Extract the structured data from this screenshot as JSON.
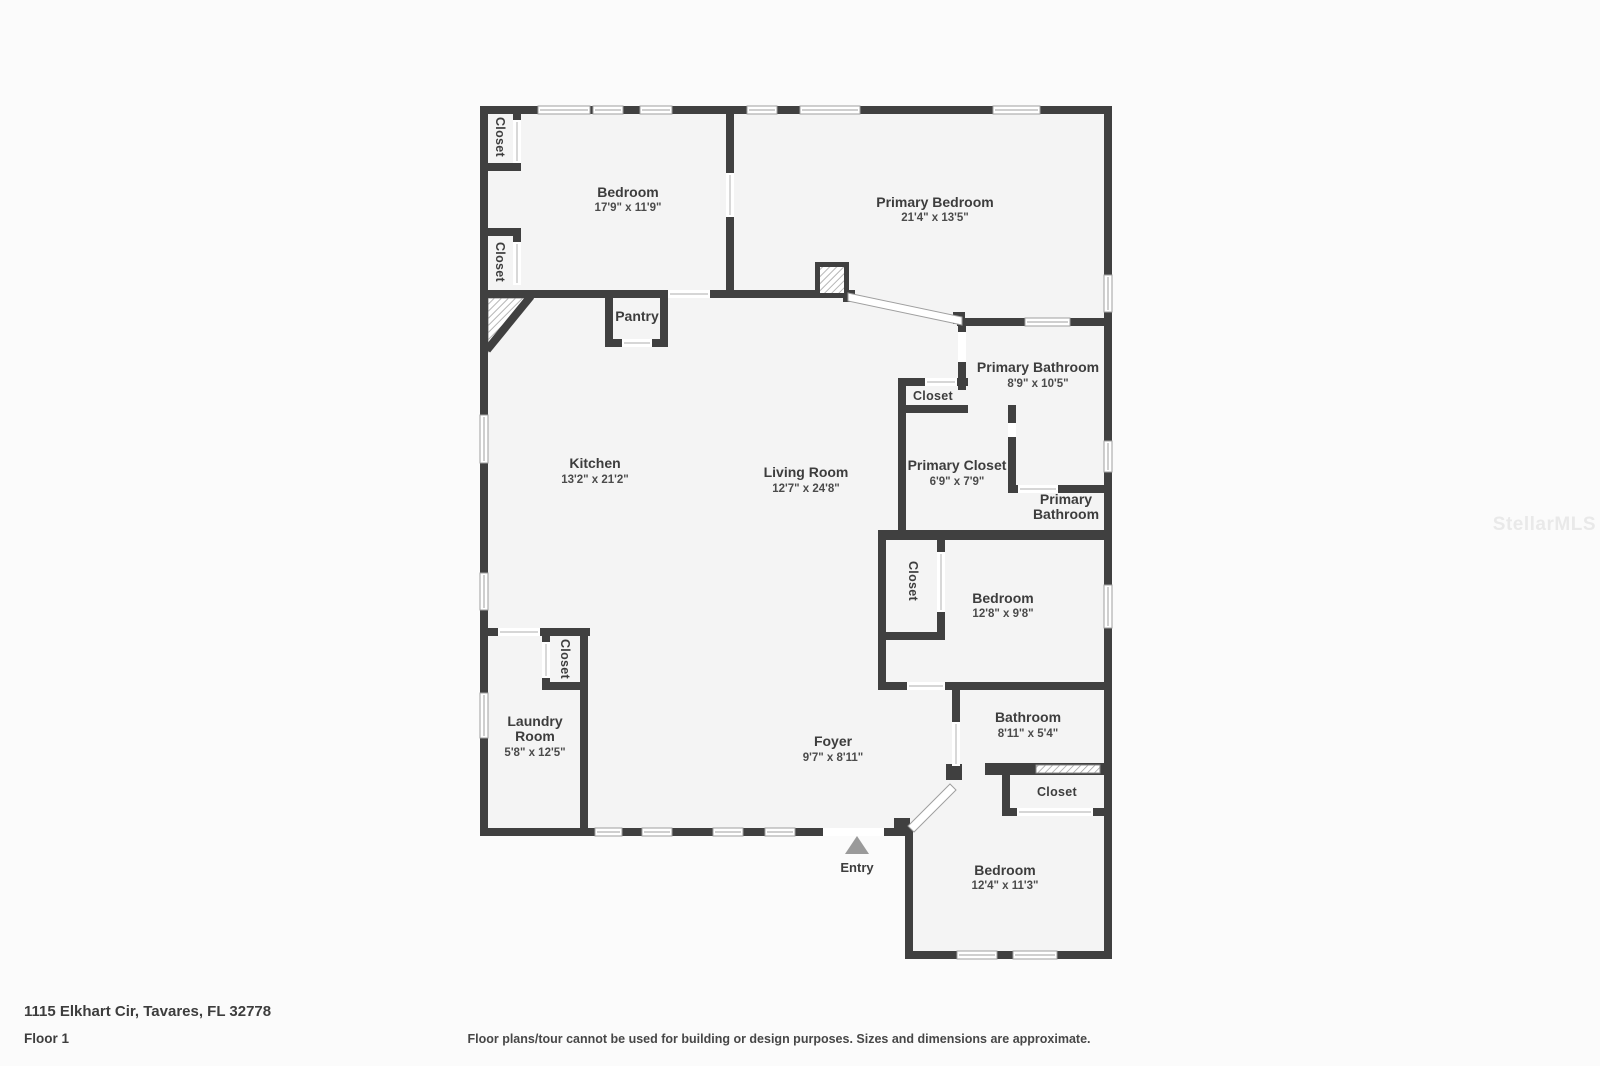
{
  "page": {
    "address": "1115 Elkhart Cir, Tavares, FL 32778",
    "floor_label": "Floor 1",
    "disclaimer": "Floor plans/tour cannot be used for building or design purposes. Sizes and dimensions are approximate.",
    "watermark": "StellarMLS"
  },
  "colors": {
    "wall": "#404040",
    "room_fill": "#f4f4f4",
    "background": "#fbfbfb",
    "label_text": "#3d3d3d",
    "entry_marker": "#9a9a9a",
    "watermark_text": "#e9e9e9"
  },
  "rooms": {
    "bedroom_top_left": {
      "name": "Bedroom",
      "dims": "17'9\" x 11'9\""
    },
    "primary_bedroom": {
      "name": "Primary Bedroom",
      "dims": "21'4\" x 13'5\""
    },
    "pantry": {
      "name": "Pantry"
    },
    "kitchen": {
      "name": "Kitchen",
      "dims": "13'2\" x 21'2\""
    },
    "living_room": {
      "name": "Living Room",
      "dims": "12'7\" x 24'8\""
    },
    "primary_bathroom": {
      "name": "Primary Bathroom",
      "dims": "8'9\" x 10'5\""
    },
    "primary_closet": {
      "name": "Primary Closet",
      "dims": "6'9\" x 7'9\""
    },
    "primary_bathroom_wc": {
      "line1": "Primary",
      "line2": "Bathroom"
    },
    "bedroom_middle": {
      "name": "Bedroom",
      "dims": "12'8\" x 9'8\""
    },
    "bathroom": {
      "name": "Bathroom",
      "dims": "8'11\" x 5'4\""
    },
    "laundry_room": {
      "line1": "Laundry",
      "line2": "Room",
      "dims": "5'8\" x 12'5\""
    },
    "foyer": {
      "name": "Foyer",
      "dims": "9'7\" x 8'11\""
    },
    "bedroom_bottom_right": {
      "name": "Bedroom",
      "dims": "12'4\" x 11'3\""
    },
    "entry": {
      "name": "Entry"
    }
  },
  "closets": {
    "top_left_upper": "Closet",
    "top_left_lower": "Closet",
    "primary_bath_closet": "Closet",
    "middle_bedroom_closet": "Closet",
    "laundry_closet": "Closet",
    "bottom_right_closet": "Closet"
  }
}
